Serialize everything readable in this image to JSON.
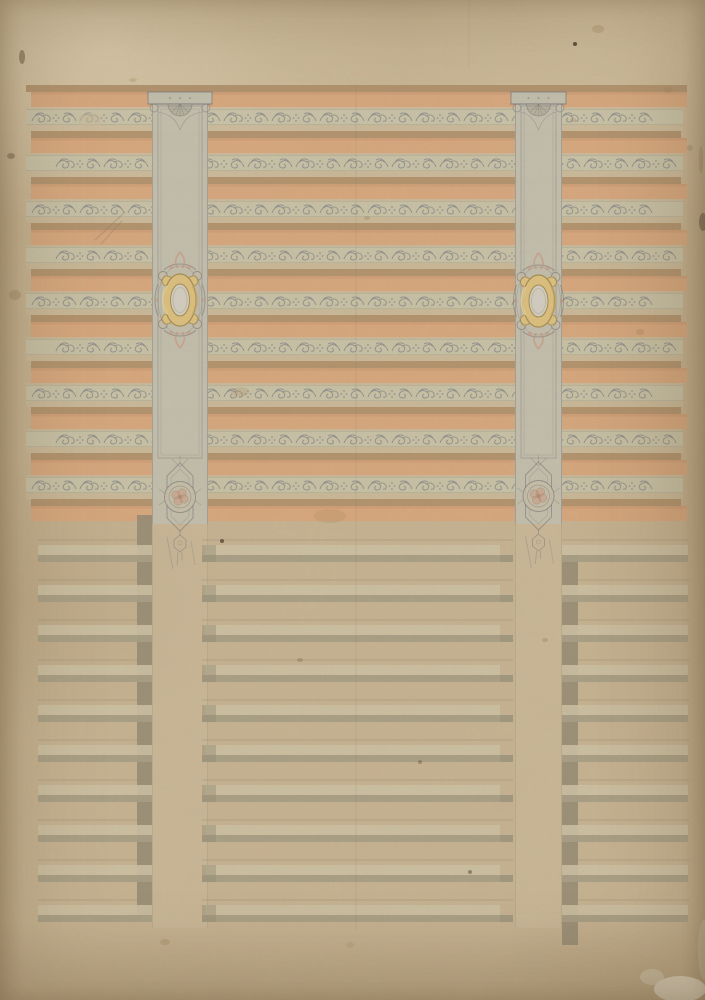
{
  "canvas": {
    "width": 705,
    "height": 1000
  },
  "palette": {
    "paper": "#c6b392",
    "upper_pale": "#cbbc9e",
    "salmon": "#d8a77c",
    "dark_tan": "#af8f6b",
    "orn_band": "#c8c3a9",
    "orn_band_edge": "#8e8d7f",
    "orn_ink": "#6b707c",
    "pilaster_wash": "#c2bfae",
    "cap_shell": "#b5b19e",
    "pencil": "#6f7277",
    "gold": "#dcc07e",
    "gold_line": "#a38c50",
    "gold_hi": "#ecd9a0",
    "gold_sh": "#c3a55e",
    "oval_core": "#d2cec2",
    "pink": "#c9927b",
    "pink_center": "#ad8770",
    "scroll_wash": "#c9c0a8",
    "lower_light": "#ccc1a4",
    "lower_dark": "#a79e86",
    "riser": "#8e8670",
    "center_cap": "#938b74",
    "pencil_line": "#998c70",
    "continuation": "#d0c2a4",
    "cont_edge": "#a6997c",
    "fold": "#8a7a5e",
    "scratch": "#8b7a5f",
    "grain_rgb": [
      0.35,
      0.28,
      0.18
    ],
    "blotch_rgb": [
      0.45,
      0.33,
      0.2
    ]
  },
  "upper": {
    "top_band": {
      "y": 85,
      "h": 7,
      "x1": 26,
      "x2": 687
    },
    "start_y": 92,
    "unit": 46,
    "units": 9,
    "salmon_h": 15,
    "gap_h": 2,
    "orn_h": 16,
    "pale_h": 6,
    "dark_h": 7,
    "orn_x1": 26,
    "orn_x2": 683,
    "fill_x1": 31,
    "fill_x2": 687,
    "dark_x2": 681,
    "final_salmon": {
      "y": 506,
      "h": 15
    }
  },
  "lower": {
    "start_y": 540,
    "unit": 40,
    "units": 10,
    "light_off": 5,
    "light_h": 10,
    "dark_h": 7,
    "left": {
      "x1": 38,
      "x2": 152,
      "riser_x": 137,
      "riser_w": 15
    },
    "center": {
      "light_x1": 205,
      "light_x2": 500,
      "dark_x1": 202,
      "dark_x2": 513,
      "cap_w": 14
    },
    "right": {
      "x1": 562,
      "x2": 688,
      "riser_x": 562,
      "riser_w": 16
    }
  },
  "pilasters": [
    {
      "name": "left",
      "x": 152,
      "w": 56,
      "cap_y": 92,
      "wash_bottom": 524,
      "cartouche_cy": 300,
      "rosette_cy": 497
    },
    {
      "name": "right",
      "x": 515,
      "w": 47,
      "cap_y": 92,
      "wash_bottom": 524,
      "cartouche_cy": 301,
      "rosette_cy": 496
    }
  ],
  "continuation_bottom": 928,
  "fold_x": 356,
  "top_margin_line_x": 469,
  "scratches": [
    [
      95,
      240,
      125,
      212
    ],
    [
      101,
      244,
      122,
      221
    ]
  ],
  "stains": [
    [
      575,
      44,
      2,
      2,
      "#473724",
      0.85
    ],
    [
      598,
      29,
      6,
      4,
      "#a08059",
      0.3
    ],
    [
      668,
      90,
      5,
      3,
      "#a08059",
      0.3
    ],
    [
      703,
      222,
      4,
      9,
      "#584634",
      0.55
    ],
    [
      701,
      160,
      2,
      14,
      "#8a7354",
      0.3
    ],
    [
      690,
      148,
      3,
      3,
      "#8a7354",
      0.3
    ],
    [
      680,
      989,
      26,
      13,
      "#ded6c3",
      0.9
    ],
    [
      652,
      977,
      12,
      8,
      "#d7cfba",
      0.55
    ],
    [
      704,
      950,
      6,
      30,
      "#c9bfa6",
      0.5
    ],
    [
      22,
      57,
      3,
      7,
      "#5f4c35",
      0.5
    ],
    [
      11,
      156,
      4,
      3,
      "#5f4c35",
      0.45
    ],
    [
      15,
      295,
      6,
      5,
      "#8f7350",
      0.3
    ],
    [
      90,
      120,
      12,
      7,
      "#cabb9c",
      0.5
    ],
    [
      240,
      392,
      9,
      5,
      "#a5825c",
      0.22
    ],
    [
      330,
      516,
      16,
      7,
      "#a1824f",
      0.18
    ],
    [
      300,
      660,
      3,
      2,
      "#6b5a40",
      0.3
    ],
    [
      420,
      762,
      2,
      2,
      "#5f4c33",
      0.4
    ],
    [
      470,
      872,
      2,
      2,
      "#4f3f2b",
      0.5
    ],
    [
      545,
      640,
      3,
      2,
      "#8a6b47",
      0.3
    ],
    [
      165,
      942,
      5,
      3,
      "#97794f",
      0.3
    ],
    [
      350,
      945,
      4,
      3,
      "#a58a62",
      0.25
    ],
    [
      222,
      541,
      2,
      2,
      "#3f3222",
      0.7
    ],
    [
      640,
      332,
      4,
      3,
      "#9b7d58",
      0.3
    ],
    [
      367,
      218,
      3,
      2,
      "#8a6b47",
      0.25
    ],
    [
      133,
      80,
      4,
      2,
      "#a58a62",
      0.3
    ],
    [
      573,
      120,
      3,
      2,
      "#9b7d58",
      0.25
    ]
  ]
}
